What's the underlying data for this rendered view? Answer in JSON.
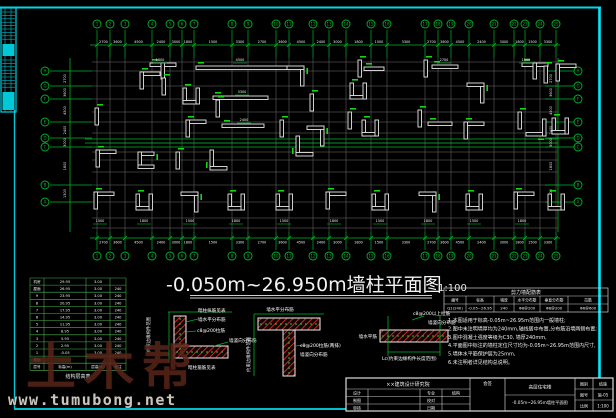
{
  "colors": {
    "background": "#000000",
    "frame_cyan": "#00e5ff",
    "cad_green": "#00b42a",
    "grid_gray": "#6f6f6f",
    "wall_white": "#e6e6e6",
    "hatch_red": "#d23030",
    "text_white": "#f0f0f0",
    "watermark_brown": "#5a2519"
  },
  "header_title": {
    "text": "-0.050m~26.950m墙柱平面图",
    "scale": "1:100"
  },
  "watermark": {
    "brand": "土木帮",
    "url": "www.tumubong.net"
  },
  "plan": {
    "grid_x": [
      97,
      110,
      125,
      152,
      170,
      182,
      194,
      232,
      248,
      276,
      289,
      313,
      329,
      346,
      371,
      387,
      425,
      438,
      451,
      469,
      494,
      514,
      525,
      540,
      556
    ],
    "grid_y": [
      62,
      71,
      86,
      99,
      112,
      122,
      133,
      143,
      152,
      160,
      172,
      185,
      202,
      218,
      228
    ],
    "top_labels": [
      "1",
      "2",
      "3",
      "4",
      "5",
      "6",
      "7",
      "8",
      "9",
      "10",
      "11",
      "12",
      "13",
      "14",
      "15",
      "16",
      "17",
      "18",
      "19",
      "20",
      "21",
      "22",
      "23",
      "24",
      "25"
    ],
    "bottom_labels": [
      "1",
      "2",
      "3",
      "4",
      "5",
      "6",
      "7",
      "8",
      "9",
      "10",
      "11",
      "12",
      "13",
      "14",
      "15",
      "16",
      "17",
      "18",
      "19",
      "20",
      "21",
      "22",
      "23",
      "24",
      "25"
    ],
    "left_labels": [
      "H",
      "G",
      "F",
      "E",
      "D",
      "C",
      "B",
      "A"
    ],
    "left_label_y": [
      71,
      86,
      99,
      122,
      138,
      147,
      185,
      202
    ],
    "right_labels": [
      "H",
      "G",
      "F",
      "E",
      "D",
      "C",
      "B",
      "A"
    ],
    "dim_values": [
      "3300",
      "2700",
      "3600",
      "4500",
      "2400",
      "3000",
      "1800",
      "1500"
    ],
    "walls": [
      {
        "t": "T",
        "x": 150,
        "y": 63,
        "r": 0
      },
      {
        "t": "H",
        "x": 196,
        "y": 66,
        "len": 92
      },
      {
        "t": "L",
        "x": 288,
        "y": 66,
        "r": 90
      },
      {
        "t": "L",
        "x": 140,
        "y": 72,
        "r": 0
      },
      {
        "t": "I",
        "x": 162,
        "y": 78,
        "r": 0
      },
      {
        "t": "C",
        "x": 183,
        "y": 88,
        "r": 0
      },
      {
        "t": "H",
        "x": 213,
        "y": 96,
        "len": 55
      },
      {
        "t": "I",
        "x": 216,
        "y": 100,
        "r": 0
      },
      {
        "t": "I",
        "x": 310,
        "y": 94,
        "r": 0
      },
      {
        "t": "L",
        "x": 296,
        "y": 140,
        "r": 270
      },
      {
        "t": "I",
        "x": 358,
        "y": 60,
        "r": 0
      },
      {
        "t": "H",
        "x": 364,
        "y": 67,
        "len": 20
      },
      {
        "t": "C",
        "x": 350,
        "y": 83,
        "r": 0
      },
      {
        "t": "I",
        "x": 424,
        "y": 60,
        "r": 0
      },
      {
        "t": "H",
        "x": 432,
        "y": 65,
        "len": 26
      },
      {
        "t": "L",
        "x": 468,
        "y": 83,
        "r": 90
      },
      {
        "t": "T",
        "x": 522,
        "y": 63,
        "r": 0
      },
      {
        "t": "I",
        "x": 544,
        "y": 66,
        "r": 0
      },
      {
        "t": "L",
        "x": 556,
        "y": 64,
        "r": 0
      },
      {
        "t": "I",
        "x": 95,
        "y": 108,
        "r": 0
      },
      {
        "t": "L",
        "x": 186,
        "y": 120,
        "r": 0
      },
      {
        "t": "H",
        "x": 222,
        "y": 124,
        "len": 42
      },
      {
        "t": "I",
        "x": 280,
        "y": 120,
        "r": 0
      },
      {
        "t": "L",
        "x": 308,
        "y": 126,
        "r": 90
      },
      {
        "t": "I",
        "x": 348,
        "y": 112,
        "r": 0
      },
      {
        "t": "C",
        "x": 362,
        "y": 120,
        "r": 0
      },
      {
        "t": "I",
        "x": 418,
        "y": 110,
        "r": 0
      },
      {
        "t": "H",
        "x": 428,
        "y": 122,
        "len": 24
      },
      {
        "t": "L",
        "x": 464,
        "y": 122,
        "r": 0
      },
      {
        "t": "I",
        "x": 518,
        "y": 112,
        "r": 0
      },
      {
        "t": "L",
        "x": 530,
        "y": 120,
        "r": 180
      },
      {
        "t": "C",
        "x": 552,
        "y": 118,
        "r": 0
      },
      {
        "t": "L",
        "x": 96,
        "y": 150,
        "r": 0
      },
      {
        "t": "C",
        "x": 138,
        "y": 152,
        "r": 90
      },
      {
        "t": "I",
        "x": 176,
        "y": 152,
        "r": 0
      },
      {
        "t": "L",
        "x": 210,
        "y": 154,
        "r": 270
      },
      {
        "t": "L",
        "x": 94,
        "y": 192,
        "r": 0
      },
      {
        "t": "C",
        "x": 136,
        "y": 194,
        "r": 0
      },
      {
        "t": "L",
        "x": 182,
        "y": 192,
        "r": 90
      },
      {
        "t": "C",
        "x": 228,
        "y": 194,
        "r": 0
      },
      {
        "t": "C",
        "x": 276,
        "y": 194,
        "r": 0
      },
      {
        "t": "L",
        "x": 326,
        "y": 192,
        "r": 0
      },
      {
        "t": "C",
        "x": 372,
        "y": 194,
        "r": 0
      },
      {
        "t": "L",
        "x": 420,
        "y": 192,
        "r": 90
      },
      {
        "t": "C",
        "x": 466,
        "y": 194,
        "r": 0
      },
      {
        "t": "L",
        "x": 514,
        "y": 192,
        "r": 0
      },
      {
        "t": "C",
        "x": 548,
        "y": 194,
        "r": 0
      }
    ],
    "dims": [
      {
        "x": 240,
        "y": 61,
        "s": "4500"
      },
      {
        "x": 242,
        "y": 93,
        "s": "3300"
      },
      {
        "x": 244,
        "y": 121,
        "s": "2400"
      },
      {
        "x": 160,
        "y": 61,
        "s": "1800"
      },
      {
        "x": 444,
        "y": 61,
        "s": "2700"
      },
      {
        "x": 526,
        "y": 61,
        "s": "1500"
      },
      {
        "x": 100,
        "y": 222,
        "s": "1500"
      },
      {
        "x": 144,
        "y": 222,
        "s": "1800"
      },
      {
        "x": 190,
        "y": 222,
        "s": "1500"
      },
      {
        "x": 236,
        "y": 222,
        "s": "1800"
      },
      {
        "x": 284,
        "y": 222,
        "s": "1500"
      },
      {
        "x": 334,
        "y": 222,
        "s": "1800"
      },
      {
        "x": 380,
        "y": 222,
        "s": "1500"
      },
      {
        "x": 428,
        "y": 222,
        "s": "1800"
      },
      {
        "x": 474,
        "y": 222,
        "s": "1500"
      },
      {
        "x": 522,
        "y": 222,
        "s": "1800"
      }
    ]
  },
  "floor_table": {
    "title": "结构层高表",
    "header": [
      "层号",
      "标高(m)",
      "层高(m)",
      "备注"
    ],
    "rows": [
      [
        "机房",
        "29.95",
        "3.00",
        ""
      ],
      [
        "屋面",
        "26.95",
        "3.00",
        "240"
      ],
      [
        "9",
        "23.95",
        "3.00",
        "240"
      ],
      [
        "8",
        "20.95",
        "3.00",
        "240"
      ],
      [
        "7",
        "17.95",
        "3.00",
        "240"
      ],
      [
        "6",
        "14.95",
        "3.00",
        "240"
      ],
      [
        "5",
        "11.95",
        "3.00",
        "240"
      ],
      [
        "4",
        "8.95",
        "3.00",
        "240"
      ],
      [
        "3",
        "5.95",
        "3.00",
        "240"
      ],
      [
        "2",
        "2.95",
        "3.00",
        "240"
      ],
      [
        "1",
        "-0.05",
        "3.00",
        "240"
      ],
      [
        "基础",
        "",
        "",
        ""
      ]
    ]
  },
  "wall_table": {
    "title": "剪力墙配筋表",
    "header": [
      "编号",
      "标高",
      "墙厚",
      "水平分布筋",
      "垂直分布筋",
      "拉筋"
    ],
    "rows": [
      [
        "Q1(240)",
        "-0.05~26.95",
        "240",
        "Φ8@200",
        "Φ8@200",
        "Φ6@600"
      ]
    ]
  },
  "notes": {
    "lines": [
      "1.本图适用于标高-0.05m~26.95m范围内一般墙柱;",
      "2.图中未注明墙厚均为240mm,轴线居中布置,分布筋沿墙两侧布置;",
      "3.图中混凝土强度等级为C30, 墙厚240mm,",
      "4.平面图中标注的墙柱定位尺寸均为-0.05m~26.95m范围内尺寸,",
      "5.墙体水平筋保护层为25mm,",
      "6.未注明者详见结构总说明。"
    ]
  },
  "details": {
    "d1": {
      "top": "暗柱纵筋见表",
      "r1": "墙水平分布筋",
      "r2": "c8@200拉筋",
      "r3": "墙竖向分布筋",
      "r4": "暗柱箍筋见表",
      "left": "约束边缘构件范围"
    },
    "d2": {
      "top": "墙水平分布筋",
      "r1": "c8@200拉筋(两排)",
      "r2": "墙竖向分布筋",
      "left": "约束边缘构件范围"
    },
    "d3": {
      "t1": "c8@200以上拉筋",
      "t2": "墙竖向分布筋",
      "l1": "墙水平筋",
      "b1": "Lc(约束边缘构件长度范围)"
    }
  },
  "titleblock": {
    "org": "××建筑设计研究院",
    "rows": [
      [
        "设计",
        "",
        "专业",
        "结构"
      ],
      [
        "制图",
        "",
        "校对",
        ""
      ],
      [
        "审核",
        "",
        "日期",
        ""
      ]
    ],
    "sign": "会签",
    "project": "高层住宅楼",
    "drawing": "-0.05m~26.95m墙柱平面图",
    "right": [
      [
        "图别",
        "结施"
      ],
      [
        "图号",
        "施-05"
      ],
      [
        "比例",
        "1:100"
      ]
    ]
  }
}
